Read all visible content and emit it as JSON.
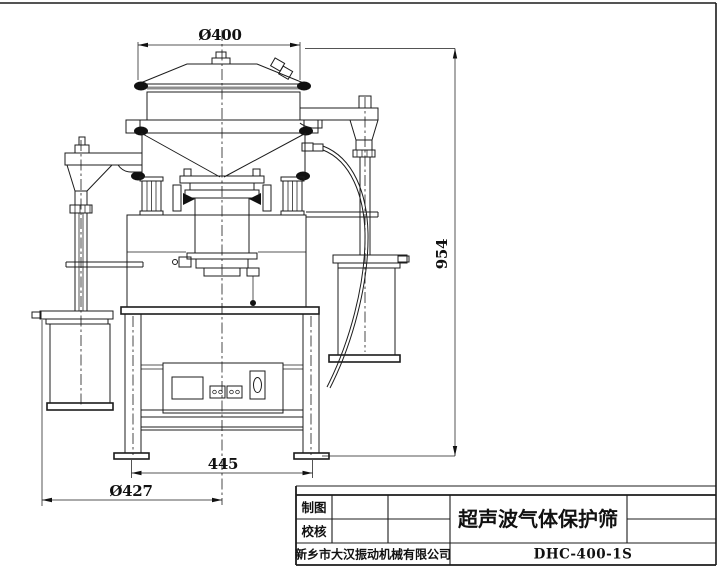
{
  "drawing": {
    "dimensions": {
      "top_diameter": "Ø400",
      "overall_height": "954",
      "leg_span": "445",
      "base_circle": "Ø427"
    },
    "title_block": {
      "drafter_label": "制图",
      "checker_label": "校核",
      "drawing_title": "超声波气体保护筛",
      "company": "新乡市大汉振动机械有限公司",
      "model": "DHC-400-1S"
    },
    "colors": {
      "line": "#1c1c1c",
      "clamp_fill": "#111111",
      "background": "#ffffff"
    }
  }
}
